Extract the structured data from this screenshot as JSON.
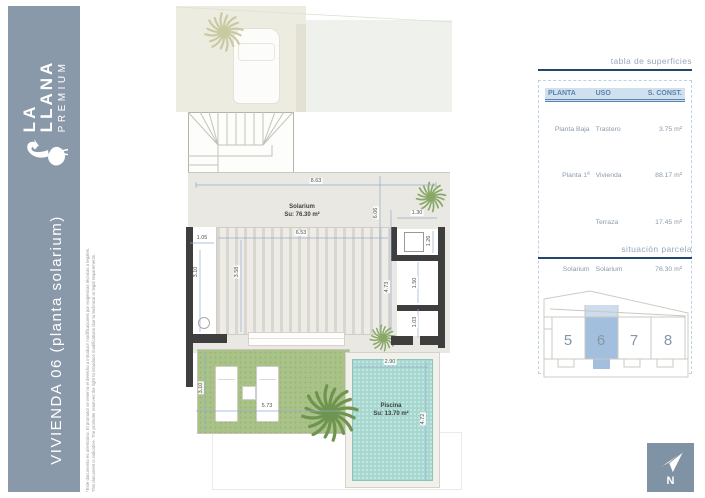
{
  "sidebar": {
    "brand_line1": "LA",
    "brand_line2": "LLANA",
    "brand_line3": "PREMIUM",
    "title": "VIVIENDA 06 (planta solarium)",
    "disclaimer_es": "*Este documento es orientativo. El promotor se reserva el derecho a introducir modificaciones por exigencias técnicas o legales.",
    "disclaimer_en": "This document is indicative. The promoter reserves the right to introduce modifications due to technical or legal requirements."
  },
  "surfaces_panel": {
    "title": "tabla de superficies",
    "table": {
      "headers": [
        "PLANTA",
        "USO",
        "S. CONST."
      ],
      "rows": [
        [
          "Planta Baja",
          "Trastero",
          "3.75 m²"
        ],
        [
          "Planta 1ª",
          "Vivienda",
          "88.17 m²"
        ],
        [
          "",
          "Terraza",
          "17.45 m²"
        ],
        [
          "Solarium",
          "Solarium",
          "76.30 m²"
        ],
        [
          "",
          "Piscina",
          "13.70 m²"
        ]
      ],
      "total": "199.37 m²"
    }
  },
  "parcel_panel": {
    "title": "situación parcela",
    "plots": [
      "5",
      "6",
      "7",
      "8"
    ],
    "highlighted_plot": "6"
  },
  "compass": {
    "label": "N"
  },
  "plan": {
    "rooms": [
      {
        "name": "Solarium",
        "area": "Su: 76.30 m²"
      },
      {
        "name": "Piscina",
        "area": "Su: 13.70 m²"
      }
    ],
    "dimensions": [
      {
        "v": "8.63",
        "x": 316,
        "y": 181,
        "rot": 0
      },
      {
        "v": "1.30",
        "x": 417,
        "y": 213,
        "rot": 0
      },
      {
        "v": "6.53",
        "x": 301,
        "y": 233,
        "rot": 0
      },
      {
        "v": "1.05",
        "x": 202,
        "y": 238,
        "rot": 0
      },
      {
        "v": "6.06",
        "x": 376,
        "y": 213,
        "rot": 90
      },
      {
        "v": "1.26",
        "x": 429,
        "y": 241,
        "rot": 90
      },
      {
        "v": "3.10",
        "x": 196,
        "y": 272,
        "rot": 90
      },
      {
        "v": "3.58",
        "x": 237,
        "y": 272,
        "rot": 90
      },
      {
        "v": "4.73",
        "x": 387,
        "y": 287,
        "rot": 90
      },
      {
        "v": "1.50",
        "x": 415,
        "y": 283,
        "rot": 90
      },
      {
        "v": "1.03",
        "x": 415,
        "y": 322,
        "rot": 90
      },
      {
        "v": "3.10",
        "x": 201,
        "y": 388,
        "rot": 90
      },
      {
        "v": "5.73",
        "x": 267,
        "y": 406,
        "rot": 0
      },
      {
        "v": "2.90",
        "x": 390,
        "y": 362,
        "rot": 0
      },
      {
        "v": "4.72",
        "x": 423,
        "y": 419,
        "rot": 90
      }
    ]
  },
  "colors": {
    "sidebar": "#8a99aa",
    "navy_rule": "#23456e",
    "table_blue": "#5d82ab",
    "table_highlight": "#cfe0ef",
    "pool": "#a7d8cf",
    "lawn": "#a9c287",
    "plot_highlight": "#a2c0dd",
    "wall": "#3e3e3e",
    "dimension_line": "#93abce"
  }
}
